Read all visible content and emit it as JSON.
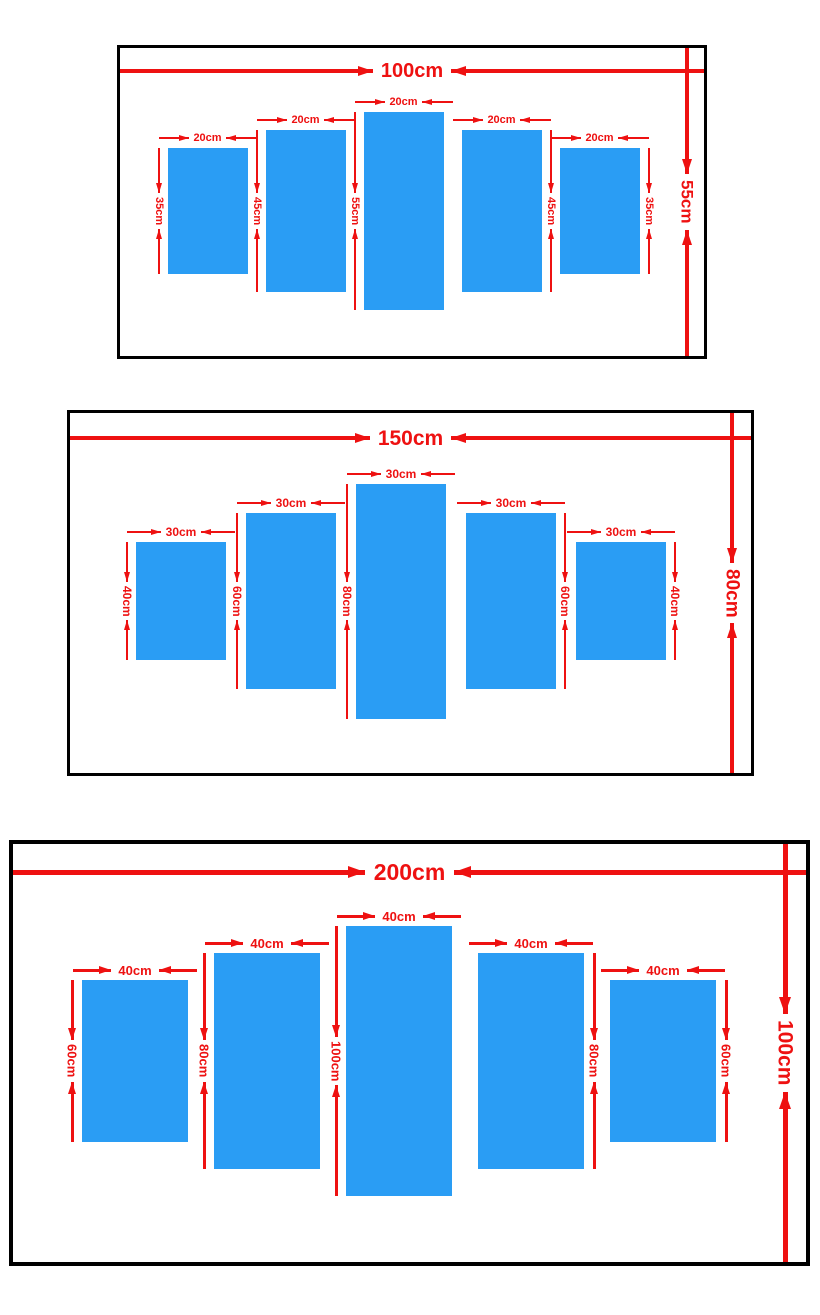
{
  "colors": {
    "panel_blue": "#2A9DF4",
    "dimension_red": "#EE1111",
    "frame_black": "#000000",
    "background": "#FFFFFF"
  },
  "diagrams": [
    {
      "id": "100x55",
      "overall": {
        "width_label": "100cm",
        "height_label": "55cm",
        "width_cm": 100,
        "height_cm": 55
      },
      "panels": [
        {
          "width_label": "20cm",
          "height_label": "35cm",
          "width_cm": 20,
          "height_cm": 35
        },
        {
          "width_label": "20cm",
          "height_label": "45cm",
          "width_cm": 20,
          "height_cm": 45
        },
        {
          "width_label": "20cm",
          "height_label": "55cm",
          "width_cm": 20,
          "height_cm": 55
        },
        {
          "width_label": "20cm",
          "height_label": "45cm",
          "width_cm": 20,
          "height_cm": 45
        },
        {
          "width_label": "20cm",
          "height_label": "35cm",
          "width_cm": 20,
          "height_cm": 35
        }
      ]
    },
    {
      "id": "150x80",
      "overall": {
        "width_label": "150cm",
        "height_label": "80cm",
        "width_cm": 150,
        "height_cm": 80
      },
      "panels": [
        {
          "width_label": "30cm",
          "height_label": "40cm",
          "width_cm": 30,
          "height_cm": 40
        },
        {
          "width_label": "30cm",
          "height_label": "60cm",
          "width_cm": 30,
          "height_cm": 60
        },
        {
          "width_label": "30cm",
          "height_label": "80cm",
          "width_cm": 30,
          "height_cm": 80
        },
        {
          "width_label": "30cm",
          "height_label": "60cm",
          "width_cm": 30,
          "height_cm": 60
        },
        {
          "width_label": "30cm",
          "height_label": "40cm",
          "width_cm": 30,
          "height_cm": 40
        }
      ]
    },
    {
      "id": "200x100",
      "overall": {
        "width_label": "200cm",
        "height_label": "100cm",
        "width_cm": 200,
        "height_cm": 100
      },
      "panels": [
        {
          "width_label": "40cm",
          "height_label": "60cm",
          "width_cm": 40,
          "height_cm": 60
        },
        {
          "width_label": "40cm",
          "height_label": "80cm",
          "width_cm": 40,
          "height_cm": 80
        },
        {
          "width_label": "40cm",
          "height_label": "100cm",
          "width_cm": 40,
          "height_cm": 100
        },
        {
          "width_label": "40cm",
          "height_label": "80cm",
          "width_cm": 40,
          "height_cm": 80
        },
        {
          "width_label": "40cm",
          "height_label": "60cm",
          "width_cm": 40,
          "height_cm": 60
        }
      ]
    }
  ]
}
